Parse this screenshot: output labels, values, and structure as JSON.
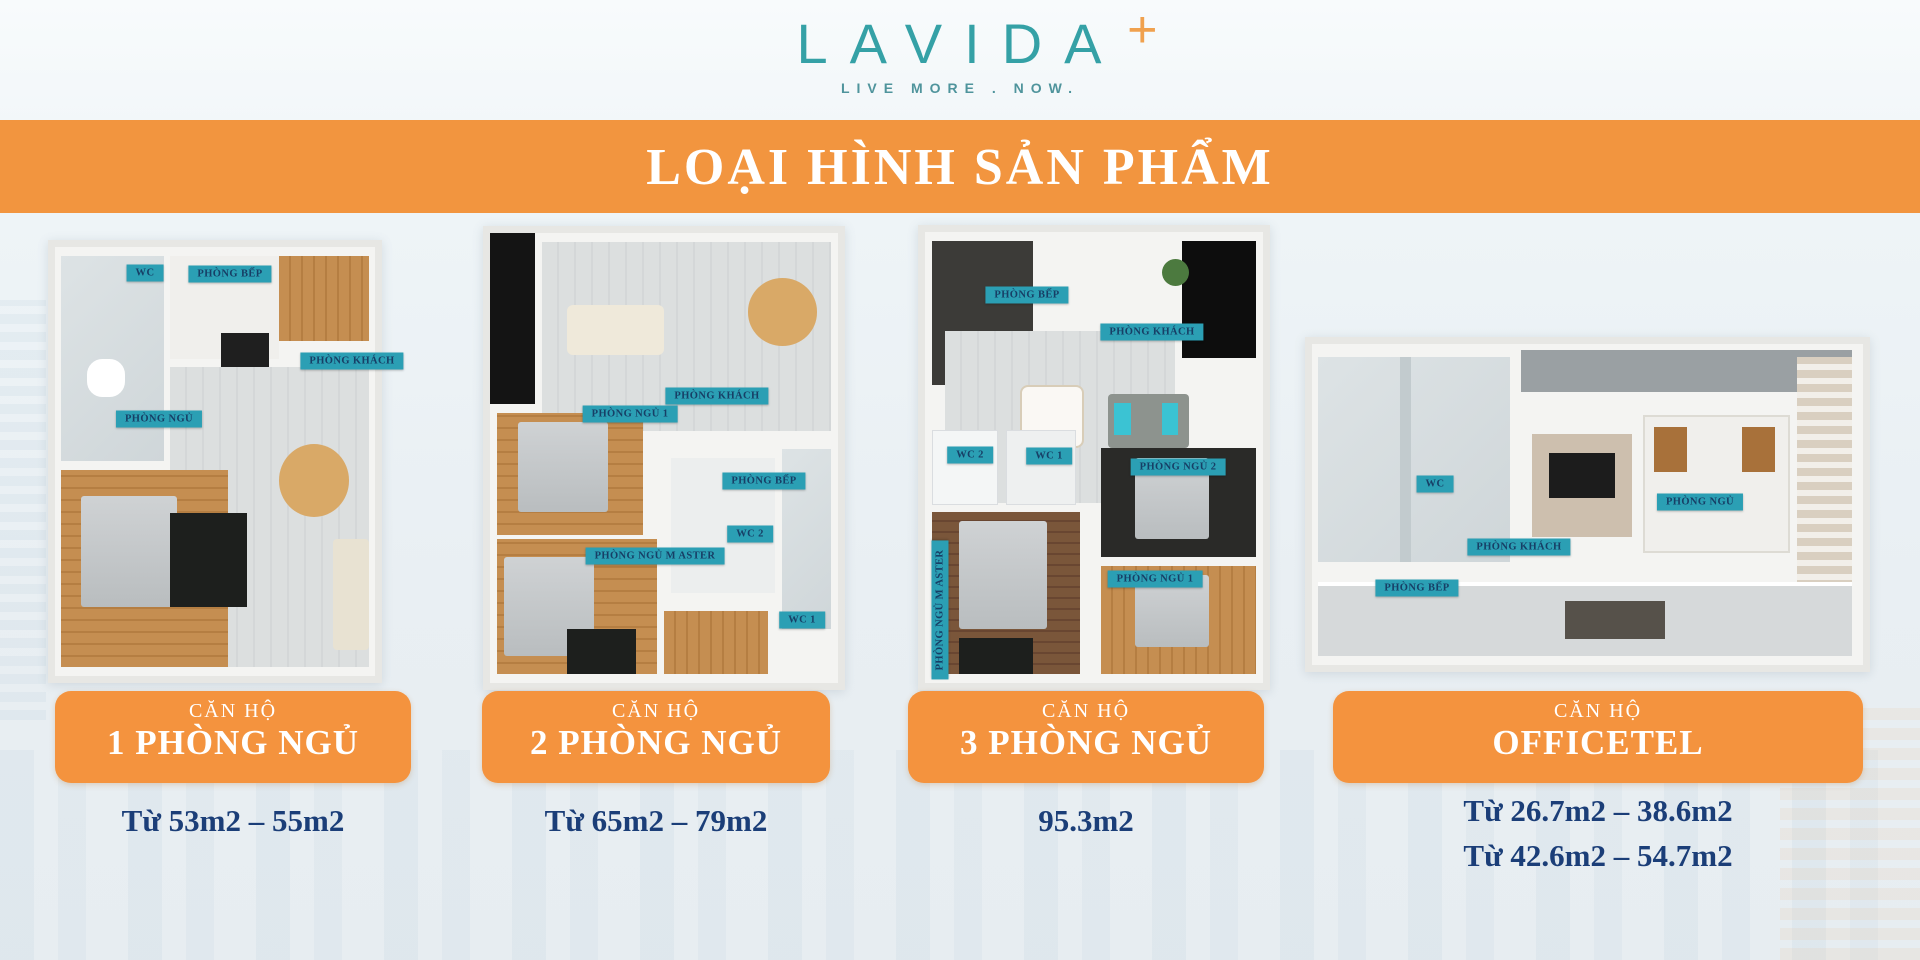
{
  "logo": {
    "brand": "LAVIDA",
    "plus": "+",
    "tagline": "LIVE MORE . NOW."
  },
  "banner": {
    "title": "LOẠI HÌNH SẢN PHẨM"
  },
  "products": [
    {
      "category": "CĂN HỘ",
      "title": "1 PHÒNG NGỦ",
      "areas": [
        "Từ 53m2 – 55m2"
      ],
      "rooms": [
        "WC",
        "PHÒNG BẾP",
        "PHÒNG KHÁCH",
        "PHÒNG NGỦ"
      ]
    },
    {
      "category": "CĂN HỘ",
      "title": "2 PHÒNG NGỦ",
      "areas": [
        "Từ 65m2 – 79m2"
      ],
      "rooms": [
        "PHÒNG KHÁCH",
        "PHÒNG NGỦ 1",
        "PHÒNG BẾP",
        "WC 2",
        "PHÒNG NGỦ M ASTER",
        "WC 1"
      ]
    },
    {
      "category": "CĂN HỘ",
      "title": "3 PHÒNG NGỦ",
      "areas": [
        "95.3m2"
      ],
      "rooms": [
        "PHÒNG BẾP",
        "PHÒNG KHÁCH",
        "WC 2",
        "WC 1",
        "PHÒNG NGỦ 2",
        "PHÒNG NGỦ 1",
        "PHÒNG NGỦ M ASTER"
      ]
    },
    {
      "category": "CĂN HỘ",
      "title": "OFFICETEL",
      "areas": [
        "Từ 26.7m2 – 38.6m2",
        "Từ 42.6m2 – 54.7m2"
      ],
      "rooms": [
        "WC",
        "PHÒNG NGỦ",
        "PHÒNG KHÁCH",
        "PHÒNG BẾP"
      ]
    }
  ],
  "colors": {
    "banner_orange": "#F2953F",
    "card_orange": "#F4933E",
    "navy_text": "#1B3E78",
    "label_teal": "#2B9FB4",
    "logo_teal": "#35A1A6",
    "logo_plus_orange": "#F0A14E"
  }
}
